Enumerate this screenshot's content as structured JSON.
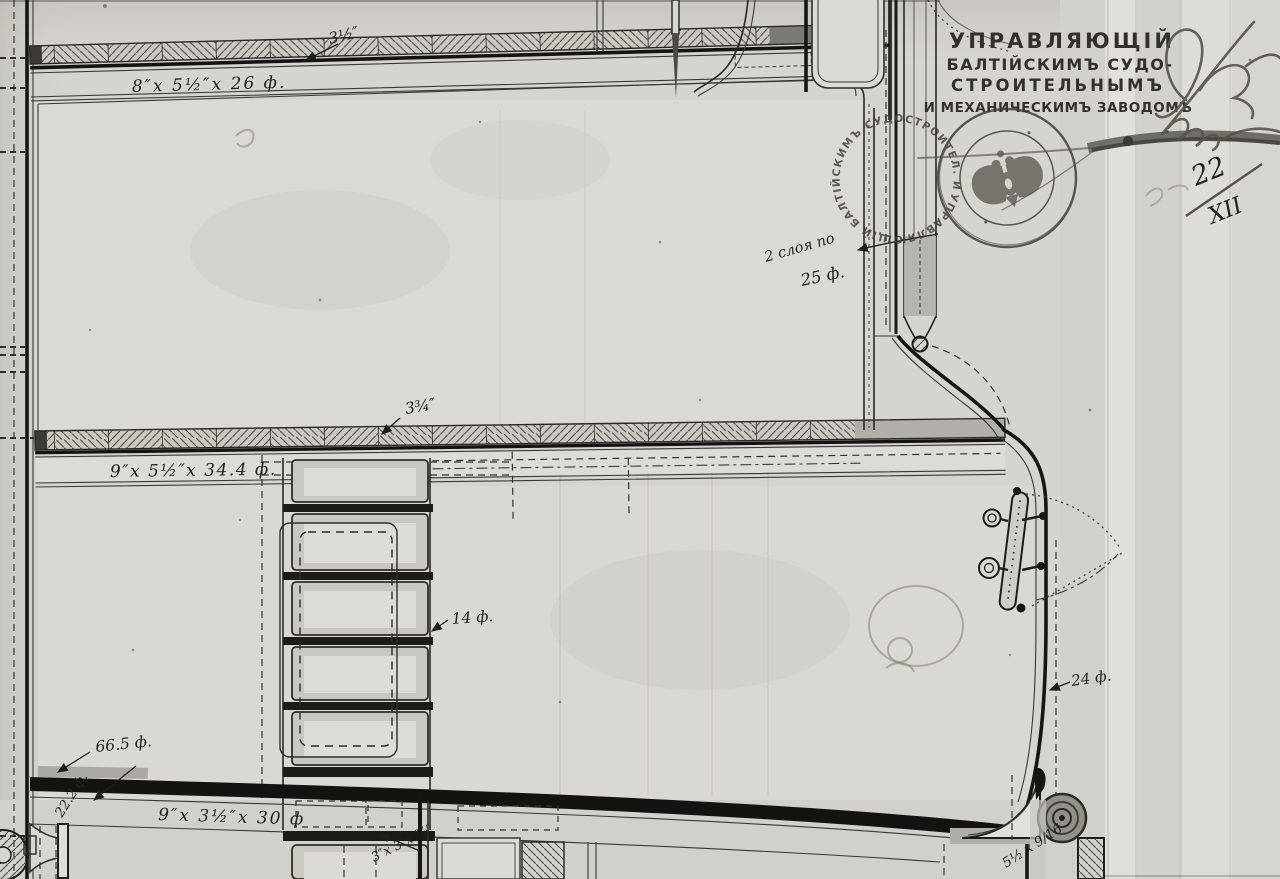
{
  "palette": {
    "paper": "#d6d4cf",
    "ink": "#1d1d1b",
    "stamp_ink": "#3c3935",
    "pencil": "#8f8b85"
  },
  "office_stamp": {
    "line1": "УПРАВЛЯЮЩІЙ",
    "line2": "БАЛТІЙСКИМЪ СУДО-",
    "line3": "СТРОИТЕЛЬНЫМЪ",
    "line4": "И МЕХАНИЧЕСКИМЪ ЗАВОДОМЪ"
  },
  "seal": {
    "rim_text": "УПРАВЛЯЮЩІЙ БАЛТІЙСКИМЪ СУДОСТРОИТЕЛ. И МЕХАНИЧ. ЗАВОДОМЪ ✱"
  },
  "date_note": {
    "numerator": "22",
    "denominator": "XII"
  },
  "annotations": {
    "plank_top_thickness": "3½″",
    "beam_top": "8″x 5½″x 26 ф.",
    "boom_note_line1": "2 слоя по",
    "boom_note_line2": "25 ф.",
    "plank_mid_thickness": "3¾″",
    "beam_mid": "9″x 5½″x 34.4 ф.",
    "skylight_length": "14 ф.",
    "deck_edge_length": "24 ф.",
    "lower_beam_length": "66.5 ф.",
    "lower_beam_width": "22.2 ф.",
    "beam_bottom": "9″x 3½″x 30 ф",
    "angle_bar": "3″x 3″x ⅜″",
    "corner_dim": "5½ x 9/16"
  }
}
